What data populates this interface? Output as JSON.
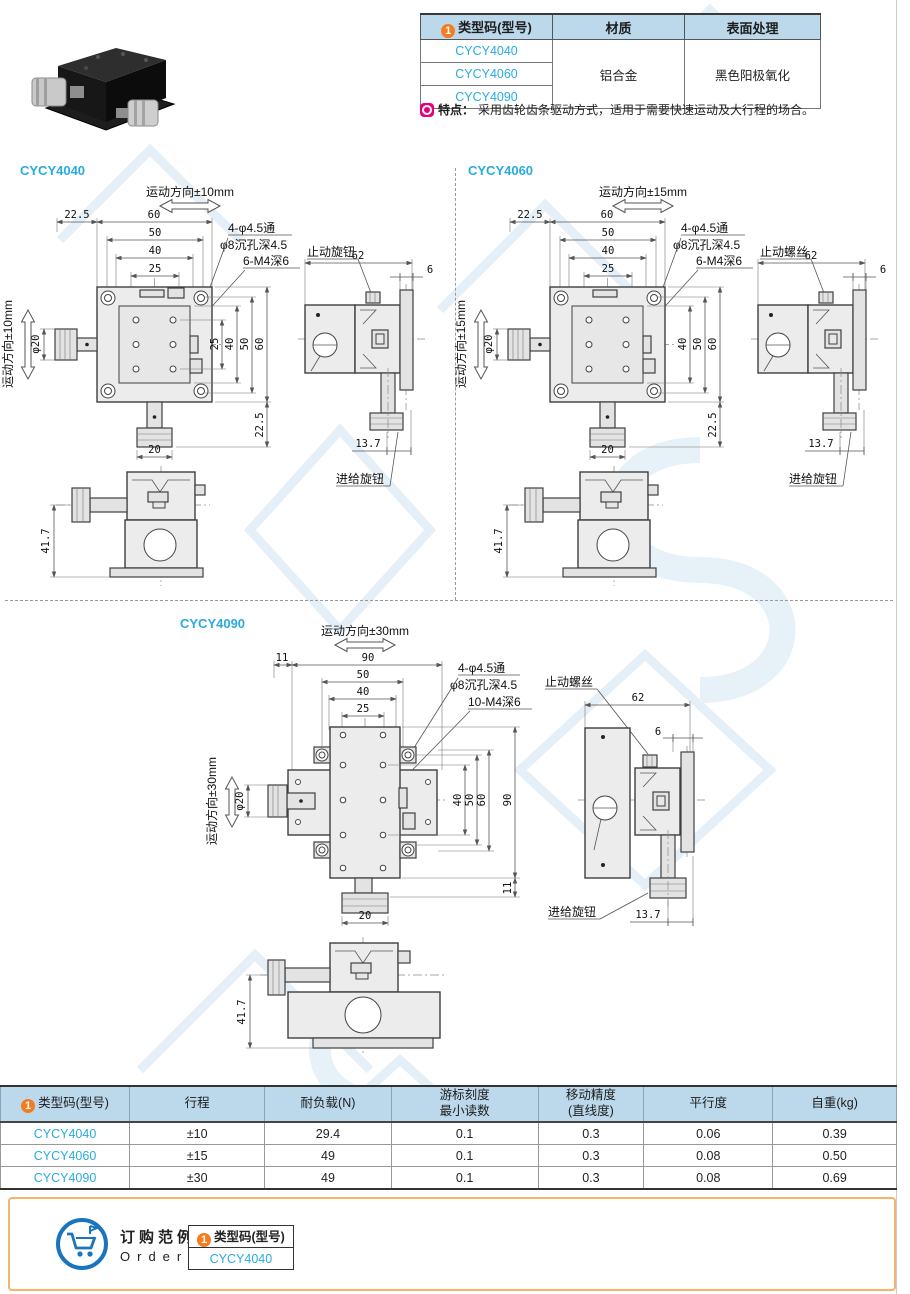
{
  "badge_num": "1",
  "colors": {
    "accent_blue": "#29abe2",
    "orange": "#f47b20",
    "header_bg": "#bcd9ec",
    "magenta": "#e6007e",
    "order_border": "#f6b26b"
  },
  "product_table": {
    "col_model": "类型码(型号)",
    "col_material": "材质",
    "col_surface": "表面处理",
    "models": [
      "CYCY4040",
      "CYCY4060",
      "CYCY4090"
    ],
    "material": "铝合金",
    "surface": "黑色阳极氧化"
  },
  "feature": {
    "label": "特点：",
    "text": "采用齿轮齿条驱动方式，适用于需要快速运动及大行程的场合。"
  },
  "d4040": {
    "title": "CYCY4040",
    "motion_h": "运动方向±10mm",
    "motion_v": "运动方向±10mm",
    "dim_225": "22.5",
    "dim_60": "60",
    "dim_50": "50",
    "dim_40": "40",
    "dim_25": "25",
    "co1": "4-φ4.5通",
    "co2": "φ8沉孔深4.5",
    "co3": "6-M4深6",
    "v25": "25",
    "v40": "40",
    "v50": "50",
    "v60": "60",
    "v225": "22.5",
    "knob_dia": "φ20",
    "dim_20": "20",
    "dim_62": "62",
    "dim_6": "6",
    "stop": "止动旋钮",
    "dim_137": "13.7",
    "feed": "进给旋钮",
    "dim_417": "41.7"
  },
  "d4060": {
    "title": "CYCY4060",
    "motion_h": "运动方向±15mm",
    "motion_v": "运动方向±15mm",
    "dim_225": "22.5",
    "dim_60": "60",
    "dim_50": "50",
    "dim_40": "40",
    "dim_25": "25",
    "co1": "4-φ4.5通",
    "co2": "φ8沉孔深4.5",
    "co3": "6-M4深6",
    "v40": "40",
    "v50": "50",
    "v60": "60",
    "v225": "22.5",
    "knob_dia": "φ20",
    "dim_20": "20",
    "dim_62": "62",
    "dim_6": "6",
    "stop": "止动螺丝",
    "dim_137": "13.7",
    "feed": "进给旋钮",
    "dim_417": "41.7"
  },
  "d4090": {
    "title": "CYCY4090",
    "motion_h": "运动方向±30mm",
    "motion_v": "运动方向±30mm",
    "dim_11": "11",
    "dim_90": "90",
    "dim_50": "50",
    "dim_40": "40",
    "dim_25": "25",
    "co1": "4-φ4.5通",
    "co2": "φ8沉孔深4.5",
    "co3": "10-M4深6",
    "v40": "40",
    "v50": "50",
    "v60": "60",
    "v90": "90",
    "v11": "11",
    "knob_dia": "φ20",
    "dim_20": "20",
    "dim_62": "62",
    "dim_6": "6",
    "stop": "止动螺丝",
    "dim_137": "13.7",
    "feed": "进给旋钮",
    "dim_417": "41.7"
  },
  "spec": {
    "h_model": "类型码(型号)",
    "h_travel": "行程",
    "h_load": "耐负载(N)",
    "h_scale1": "游标刻度",
    "h_scale2": "最小读数",
    "h_acc1": "移动精度",
    "h_acc2": "(直线度)",
    "h_par": "平行度",
    "h_weight": "自重(kg)",
    "rows": [
      {
        "model": "CYCY4040",
        "travel": "±10",
        "load": "29.4",
        "scale": "0.1",
        "acc": "0.3",
        "par": "0.06",
        "weight": "0.39"
      },
      {
        "model": "CYCY4060",
        "travel": "±15",
        "load": "49",
        "scale": "0.1",
        "acc": "0.3",
        "par": "0.08",
        "weight": "0.50"
      },
      {
        "model": "CYCY4090",
        "travel": "±30",
        "load": "49",
        "scale": "0.1",
        "acc": "0.3",
        "par": "0.08",
        "weight": "0.69"
      }
    ]
  },
  "order": {
    "cn": "订购范例",
    "en": "Order",
    "header": "类型码(型号)",
    "model": "CYCY4040"
  }
}
